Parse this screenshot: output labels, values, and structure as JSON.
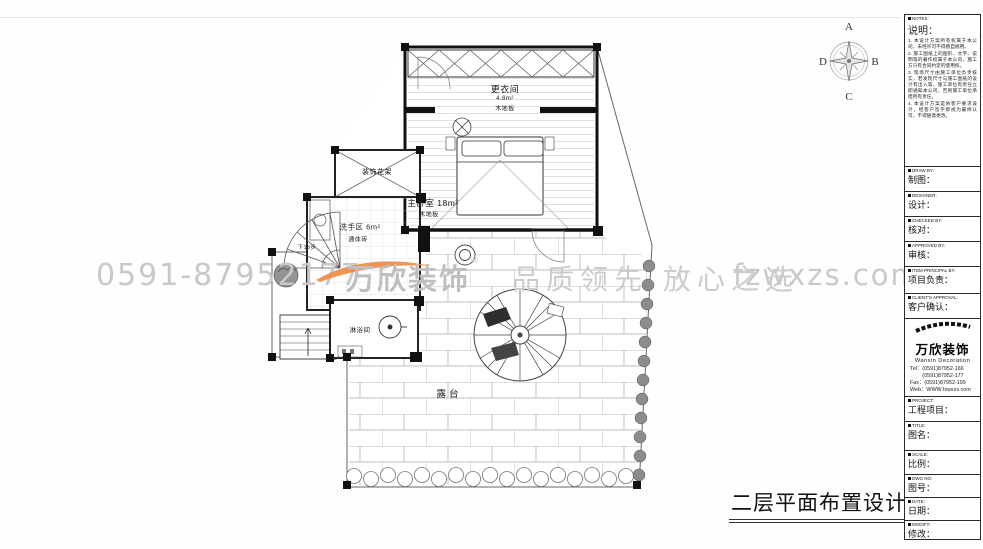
{
  "sheet": {
    "title": "二层平面布置设计图"
  },
  "compass": {
    "north": "A",
    "east": "B",
    "south": "C",
    "west": "D"
  },
  "watermark": {
    "phone": "0591-87952177",
    "brand": "万欣装饰",
    "reg": "®",
    "slogan": "品质领先 放心之选",
    "website": "fzwxzs.com",
    "orange": "#ee8a3e",
    "gray": "#c8c8c8"
  },
  "plan": {
    "dressing_room": {
      "name": "更衣间",
      "area": "4.8m²",
      "finish": "木地板"
    },
    "master_bedroom": {
      "name": "主卧室 18m²",
      "finish": "木地板"
    },
    "flower_rack": {
      "name": "装饰花架"
    },
    "wash_area": {
      "name": "洗手区 6m²",
      "finish": "通体砖"
    },
    "stair_note": "下15步",
    "shower_room": "淋浴间",
    "terrace": "露台"
  },
  "titleblock": {
    "notes": {
      "header": "NOTES:",
      "title": "说明：",
      "items": [
        "1. 本设计方案所有权属于本公司，未经许可不得擅自挪用。",
        "2. 施工图纸上的图形、文字、说明等的著作权属于本公司，施工方只有合同约定的使用权。",
        "3. 现场尺寸由施工单位负责核实，若发现尺寸与施工图纸的设计有出入等，施工单位有责任立即通知本公司，否则施工单位承担所有责任。",
        "4. 本设计方案是依客户要求设计，经客户签字即视为最终认可，不得随意更改。"
      ]
    },
    "rows": [
      {
        "header": "DRAW BY:",
        "label": "制图："
      },
      {
        "header": "DESIGNER:",
        "label": "设计："
      },
      {
        "header": "CHECKED BY:",
        "label": "核对："
      },
      {
        "header": "APPROVED BY:",
        "label": "审核："
      },
      {
        "header": "ITEM PRINCIPAL BY:",
        "label": "项目负责："
      },
      {
        "header": "CLIENT'S APPROVAL:",
        "label": "客户确认："
      }
    ],
    "company": {
      "name_cn": "万欣装饰",
      "name_en": "Wanxin Decoration",
      "tel1": "Tel：(0591)87952-166",
      "tel2": "　　 (0591)87952-177",
      "fax": "Fax：(0591)87952-199",
      "web": "Web：WWW.fzwxzs.com"
    },
    "rows2": [
      {
        "header": "PROJECT:",
        "label": "工程项目："
      },
      {
        "header": "TITLE:",
        "label": "图名："
      },
      {
        "header": "SCALE:",
        "label": "比例："
      },
      {
        "header": "DWG NO:",
        "label": "图号："
      },
      {
        "header": "DATE:",
        "label": "日期："
      },
      {
        "header": "MODIFY:",
        "label": "修改："
      }
    ]
  }
}
